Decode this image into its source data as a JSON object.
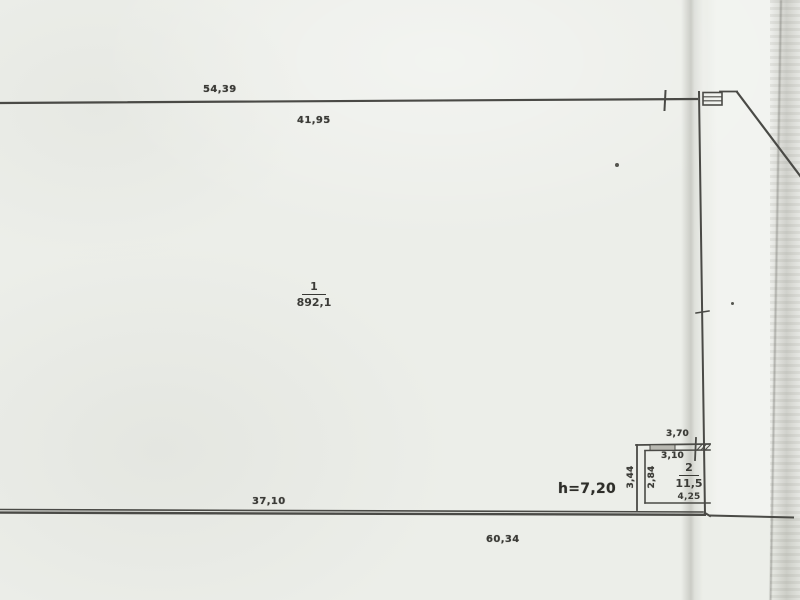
{
  "colors": {
    "paper": "#eceee9",
    "ink": "#4a4a46",
    "ink_dark": "#383834",
    "text": "#3b3b37"
  },
  "plan": {
    "parcel": {
      "number": "1",
      "area": "892,1",
      "dim_top_outer": "54,39",
      "dim_top_inner": "41,95",
      "dim_bottom_inner": "37,10",
      "dim_bottom_outer": "60,34",
      "height_note": "h=7,20"
    },
    "room2": {
      "number": "2",
      "area": "11,5",
      "dim_top_outer": "3,70",
      "dim_top_inner": "3,10",
      "dim_bottom_inner": "4,25",
      "dim_left_outer": "3,44",
      "dim_left_inner": "2,84"
    }
  }
}
